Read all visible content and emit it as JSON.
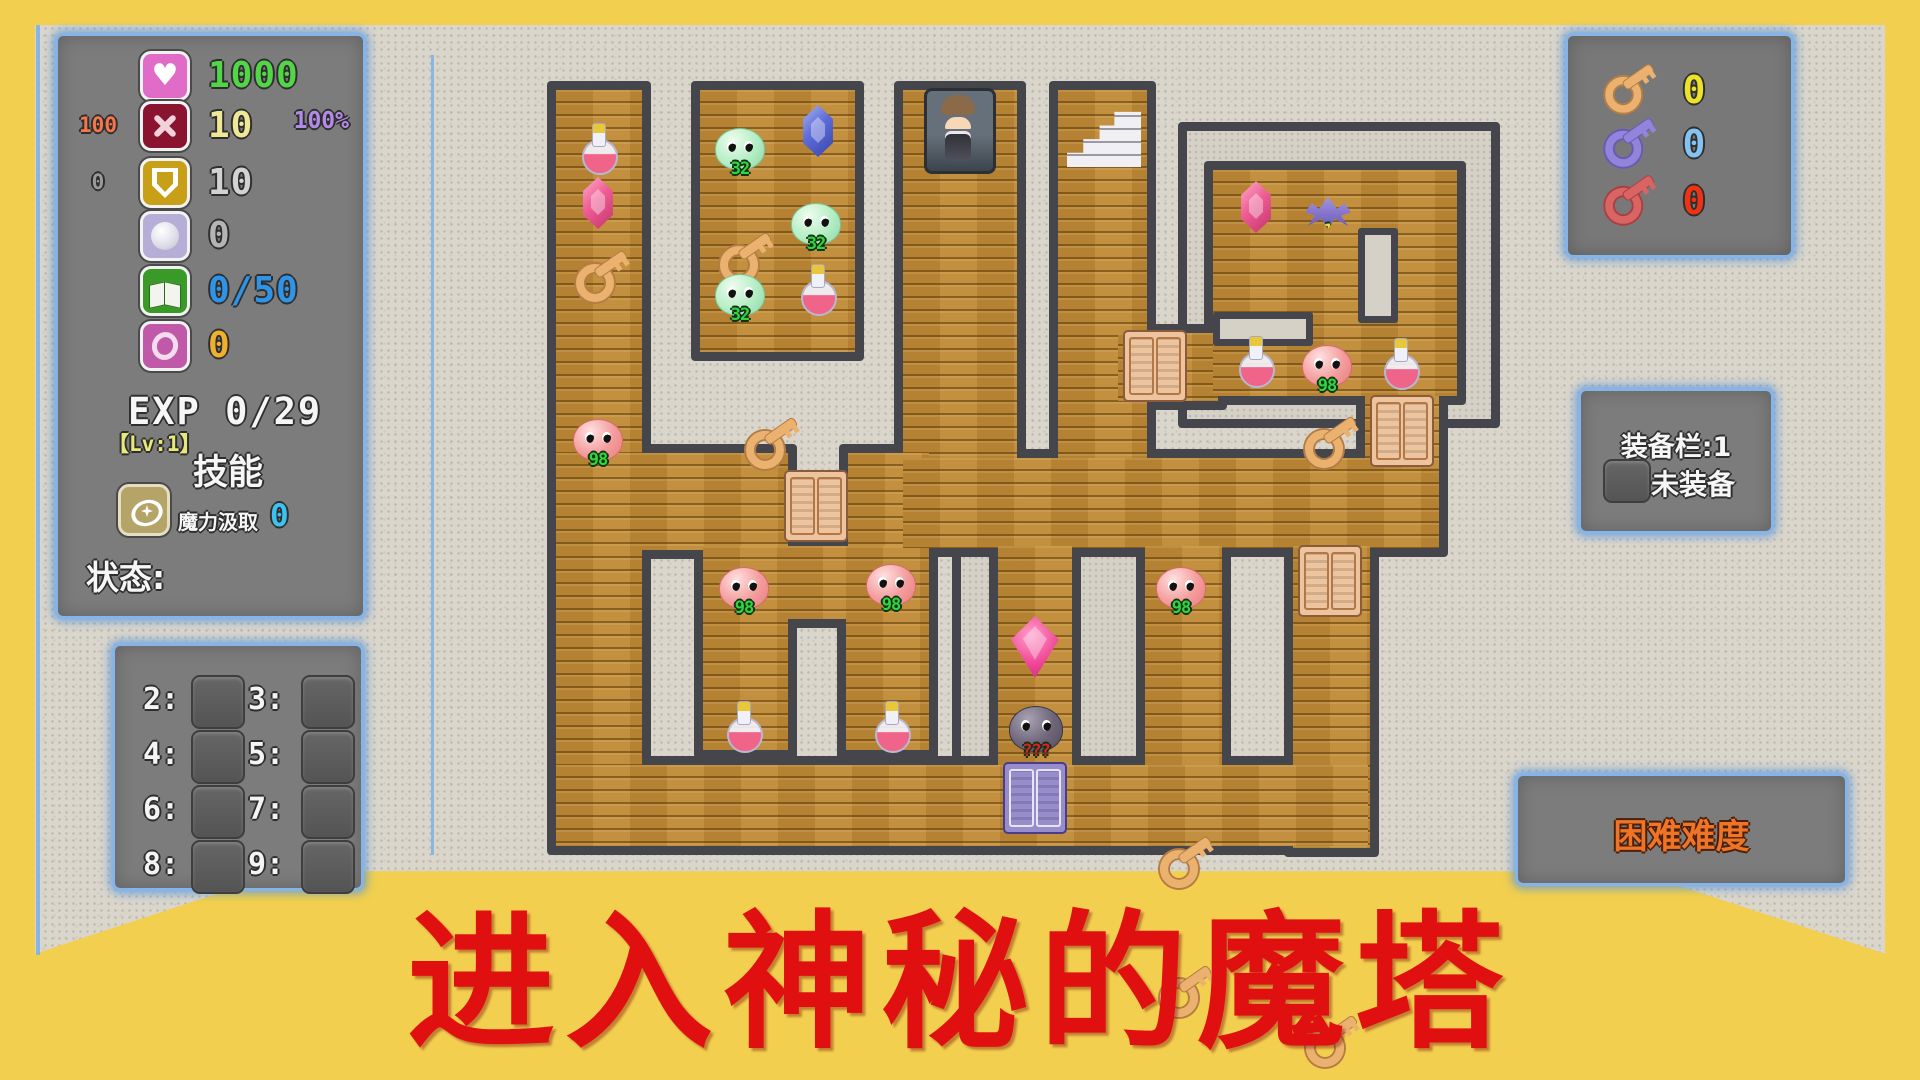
{
  "title": {
    "text": "进入神秘的魔塔"
  },
  "hud": {
    "stats": {
      "rows": [
        {
          "icon": "heart",
          "value": "1000",
          "color": "#52d648",
          "side": "",
          "side_color": ""
        },
        {
          "icon": "attack",
          "value": "10",
          "color": "#efe896",
          "side": "100",
          "side_color": "#f4764a"
        },
        {
          "icon": "shield",
          "value": "10",
          "color": "#d2d2d2",
          "side": "0",
          "side_color": "#9a9a9a"
        },
        {
          "icon": "orb",
          "value": "0",
          "color": "#b4b4b4",
          "side": "",
          "side_color": ""
        },
        {
          "icon": "book",
          "value": "0/50",
          "color": "#2f93e8",
          "side": "",
          "side_color": ""
        },
        {
          "icon": "coin",
          "value": "0",
          "color": "#f0b02c",
          "side": "",
          "side_color": ""
        }
      ],
      "percent": "100%",
      "percent_color": "#b48ae8",
      "exp_label": "EXP",
      "exp_value": "0/29",
      "level": "【Lv:1】",
      "skills_title": "技能",
      "skill_name": "魔力汲取",
      "skill_value": "0",
      "skill_value_color": "#3cc2f0",
      "status_label": "状态:"
    },
    "floor_shortcuts": {
      "rows": [
        [
          "2",
          "3"
        ],
        [
          "4",
          "5"
        ],
        [
          "6",
          "7"
        ],
        [
          "8",
          "9"
        ]
      ]
    },
    "key_inventory": [
      {
        "name": "yellow-key",
        "key_color": "#eab26e",
        "ring_color": "#b57c44",
        "count": "0",
        "count_color": "#ece22a"
      },
      {
        "name": "blue-key",
        "key_color": "#9184da",
        "ring_color": "#6a58b8",
        "count": "0",
        "count_color": "#84c2f2"
      },
      {
        "name": "red-key",
        "key_color": "#d86464",
        "ring_color": "#b03c3c",
        "count": "0",
        "count_color": "#f03214"
      }
    ],
    "equipment": {
      "title": "装备栏:1",
      "slot_label": "未装备"
    },
    "difficulty": {
      "label": "困难难度",
      "color": "#f07428"
    }
  },
  "map": {
    "floors": [
      [
        556,
        90,
        86,
        680
      ],
      [
        700,
        90,
        155,
        262
      ],
      [
        903,
        90,
        114,
        380
      ],
      [
        1058,
        90,
        89,
        380
      ],
      [
        556,
        453,
        232,
        97
      ],
      [
        848,
        453,
        81,
        170
      ],
      [
        786,
        546,
        143,
        73
      ],
      [
        703,
        546,
        85,
        204
      ],
      [
        846,
        546,
        83,
        204
      ],
      [
        903,
        458,
        536,
        90
      ],
      [
        998,
        546,
        74,
        229
      ],
      [
        1145,
        546,
        77,
        228
      ],
      [
        1293,
        546,
        77,
        302
      ],
      [
        1365,
        393,
        74,
        75
      ],
      [
        1118,
        333,
        100,
        68
      ],
      [
        1213,
        170,
        244,
        226
      ],
      [
        556,
        765,
        812,
        81
      ]
    ],
    "stones": [
      [
        952,
        468,
        200,
        307
      ],
      [
        1178,
        122,
        322,
        306
      ]
    ],
    "stubs": [
      [
        1358,
        228,
        40,
        95
      ],
      [
        1213,
        312,
        100,
        34
      ]
    ],
    "doors": [
      {
        "c": "tan",
        "x": 816,
        "y": 506
      },
      {
        "c": "tan",
        "x": 1155,
        "y": 366
      },
      {
        "c": "tan",
        "x": 1402,
        "y": 431
      },
      {
        "c": "tan",
        "x": 1330,
        "y": 581
      },
      {
        "c": "purple",
        "x": 1035,
        "y": 798
      }
    ],
    "entities": [
      {
        "t": "potion",
        "x": 598,
        "y": 149
      },
      {
        "t": "gem",
        "v": "pink",
        "x": 598,
        "y": 203
      },
      {
        "t": "key",
        "v": "gold",
        "x": 600,
        "y": 278
      },
      {
        "t": "slime",
        "v": "red",
        "label": "98",
        "x": 598,
        "y": 440
      },
      {
        "t": "slime",
        "v": "green",
        "label": "32",
        "x": 740,
        "y": 149
      },
      {
        "t": "gem",
        "v": "blue",
        "x": 818,
        "y": 131
      },
      {
        "t": "key",
        "v": "gold",
        "x": 744,
        "y": 204
      },
      {
        "t": "slime",
        "v": "green",
        "label": "32",
        "x": 816,
        "y": 224
      },
      {
        "t": "slime",
        "v": "green",
        "label": "32",
        "x": 740,
        "y": 295
      },
      {
        "t": "potion",
        "x": 817,
        "y": 290
      },
      {
        "t": "key",
        "v": "gold",
        "x": 770,
        "y": 333
      },
      {
        "t": "player",
        "x": 960,
        "y": 131
      },
      {
        "t": "stairs",
        "x": 1104,
        "y": 133
      },
      {
        "t": "gem",
        "v": "pink",
        "x": 1256,
        "y": 207
      },
      {
        "t": "bat",
        "label": "410",
        "x": 1328,
        "y": 214
      },
      {
        "t": "key",
        "v": "gold",
        "x": 1329,
        "y": 276
      },
      {
        "t": "potion",
        "x": 1255,
        "y": 362
      },
      {
        "t": "slime",
        "v": "red",
        "label": "98",
        "x": 1327,
        "y": 366
      },
      {
        "t": "potion",
        "x": 1400,
        "y": 364
      },
      {
        "t": "slime",
        "v": "red",
        "label": "98",
        "x": 744,
        "y": 588
      },
      {
        "t": "slime",
        "v": "red",
        "label": "98",
        "x": 891,
        "y": 585
      },
      {
        "t": "slime",
        "v": "red",
        "label": "98",
        "x": 1181,
        "y": 588
      },
      {
        "t": "key",
        "v": "gold",
        "x": 1184,
        "y": 640
      },
      {
        "t": "key",
        "v": "gold",
        "x": 1184,
        "y": 713
      },
      {
        "t": "key",
        "v": "gold",
        "x": 1330,
        "y": 707
      },
      {
        "t": "potion",
        "x": 743,
        "y": 727
      },
      {
        "t": "potion",
        "x": 891,
        "y": 727
      },
      {
        "t": "crystal",
        "x": 1035,
        "y": 647
      },
      {
        "t": "boss",
        "label": "???",
        "x": 1036,
        "y": 729
      }
    ]
  }
}
